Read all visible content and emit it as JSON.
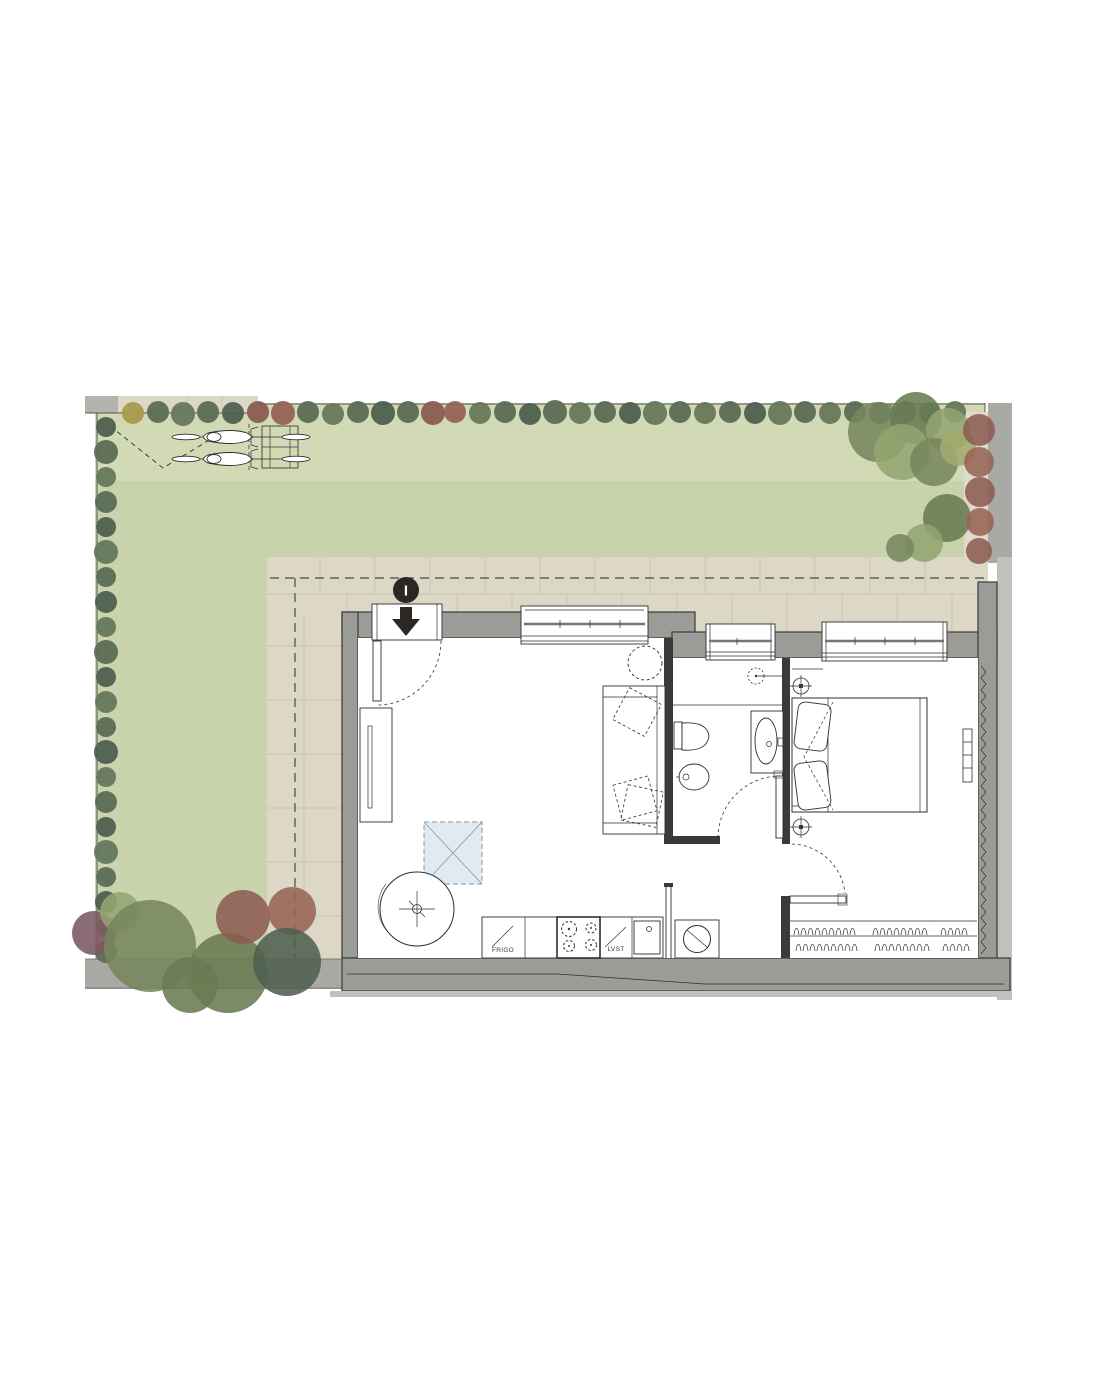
{
  "plan": {
    "entrance": {
      "marker_label": "I"
    },
    "kitchen": {
      "fridge_label": "FRIGO",
      "dishwasher_label": "LVST"
    }
  },
  "colors": {
    "page_bg": "#ffffff",
    "grass": "#ccd6b0",
    "grass_light": "#d6dfbc",
    "grass_dark": "#c4cfa6",
    "paving": "#ddd8c6",
    "paving_joint": "#c6c0ac",
    "paving_gray": "#b3b3af",
    "boundary_gray": "#a9a9a5",
    "boundary_light": "#c0c0bc",
    "wall_gray": "#9b9b97",
    "wall_dark": "#3a3a3a",
    "room_white": "#ffffff",
    "line_dark": "#2f2f2f",
    "glazing_gray": "#77776f",
    "skylight_blue": "#dfeaf2",
    "hedge_green": "#5c6d55",
    "hedge_green_alt": "#66785c",
    "hedge_dark": "#4f6050",
    "hedge_yellow": "#a79a4e",
    "tree_green": "#76865c",
    "tree_green_dark": "#697b52",
    "tree_green_light": "#93a471",
    "tree_olive": "#a4aa6e",
    "tree_red": "#8c5c52",
    "tree_red_light": "#966457",
    "tree_purple": "#7b5661",
    "marker_black": "#2b2724"
  }
}
